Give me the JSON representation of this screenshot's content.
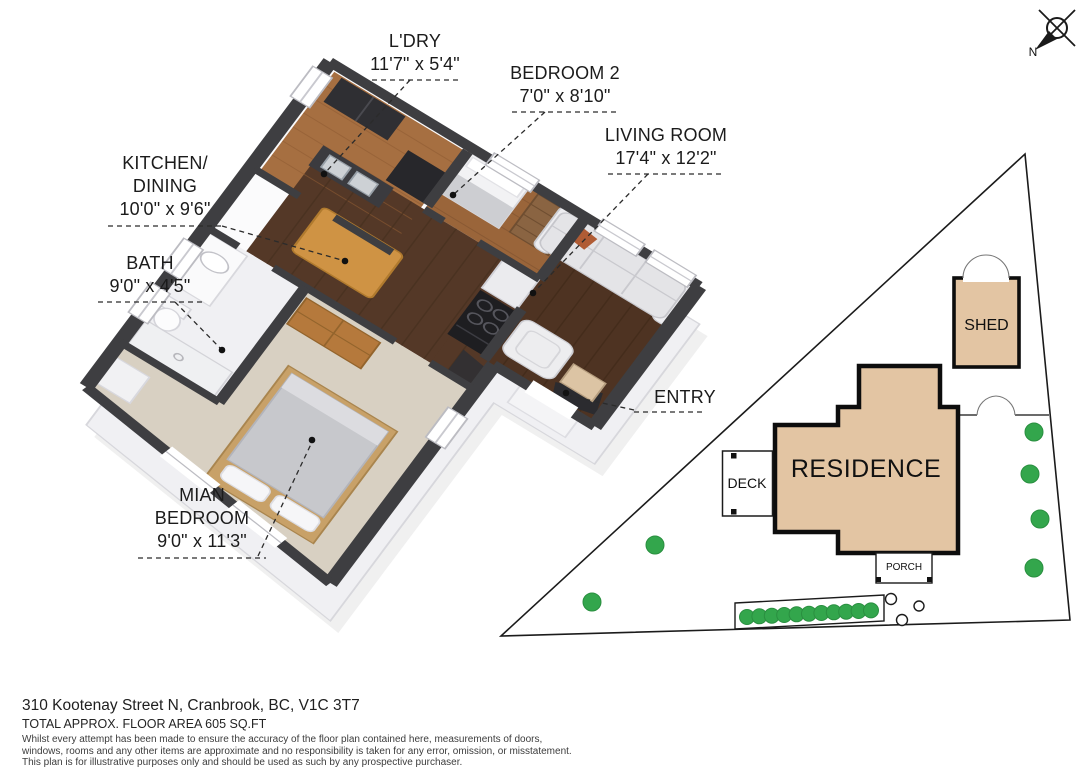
{
  "floor_plan": {
    "labels": {
      "ldry": {
        "line1": "L'DRY",
        "dims": "11'7\" x 5'4\""
      },
      "bedroom2": {
        "line1": "BEDROOM 2",
        "dims": "7'0\" x 8'10\""
      },
      "living": {
        "line1": "LIVING ROOM",
        "dims": "17'4\" x 12'2\""
      },
      "kitchen": {
        "line1": "KITCHEN/",
        "line2": "DINING",
        "dims": "10'0\" x 9'6\""
      },
      "bath": {
        "line1": "BATH",
        "dims": "9'0\" x 4'5\""
      },
      "main_bedroom": {
        "line1": "MIAN",
        "line2": "BEDROOM",
        "dims": "9'0\" x 11'3\""
      },
      "entry": {
        "line1": "ENTRY"
      }
    }
  },
  "site_plan": {
    "residence": "RESIDENCE",
    "deck": "DECK",
    "porch": "PORCH",
    "shed": "SHED",
    "north": "N",
    "tree_count": 17
  },
  "footer": {
    "address": "310 Kootenay Street N, Cranbrook, BC, V1C 3T7",
    "area": "TOTAL APPROX. FLOOR AREA 605 SQ.FT",
    "disclaimer": [
      "Whilst every attempt has been made to ensure the accuracy of the floor plan contained here, measurements of doors,",
      "windows, rooms and any other items are approximate and no responsibility is taken for any error, omission, or misstatement.",
      "This plan is for illustrative purposes only and should be used as such by any prospective purchaser."
    ]
  },
  "colors": {
    "wall_dark": "#3e3e41",
    "residence_fill": "#e3c5a3",
    "tree_green": "#33a64c",
    "wood_light": "#a66f41",
    "wood_dark": "#543827",
    "carpet": "#d8d0c2"
  }
}
